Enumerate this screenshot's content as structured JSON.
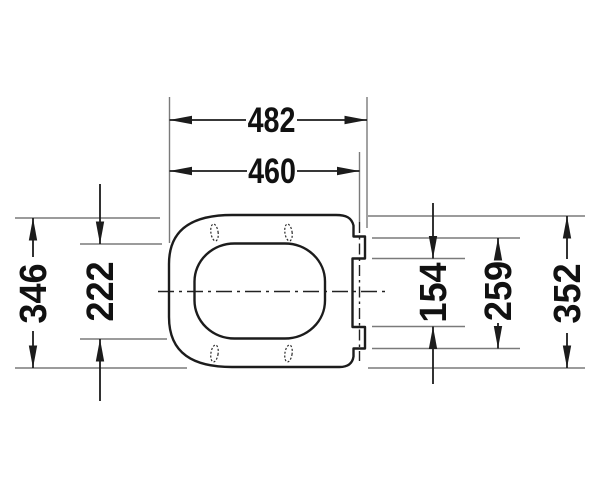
{
  "drawing": {
    "type": "technical-dimension-drawing",
    "subject": "toilet seat and cover, top view",
    "unit": "mm",
    "labels": {
      "overall_length": "482",
      "length_to_hinge_axis": "460",
      "seat_outer_width": "346",
      "inner_opening_width": "222",
      "hinge_inner_span": "154",
      "hinge_outer_span": "259",
      "cover_width": "352"
    },
    "colors": {
      "outline": "#1c1c1c",
      "dimension_lines": "#1c1c1c",
      "extension_lines": "#7a7a7a",
      "text": "#111111",
      "background": "#ffffff"
    }
  }
}
